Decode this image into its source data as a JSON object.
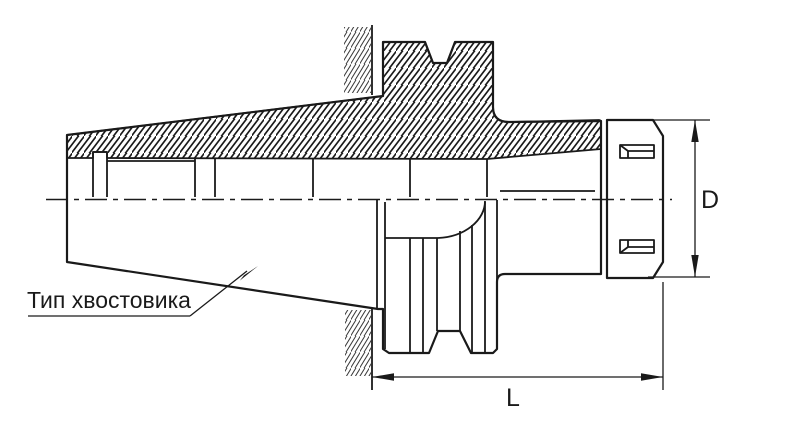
{
  "drawing": {
    "labels": {
      "shank_type": "Тип хвостовика",
      "diameter": "D",
      "length": "L"
    },
    "colors": {
      "body_fill": "#F8DE92",
      "line": "#1a1a1a",
      "background": "#ffffff"
    }
  }
}
